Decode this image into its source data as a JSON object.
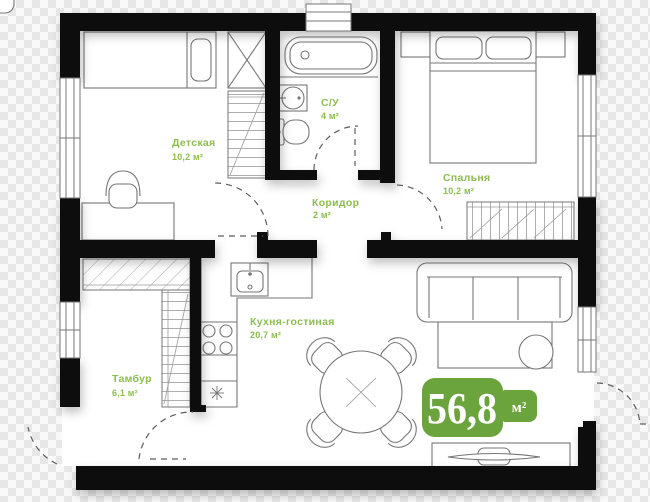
{
  "plan": {
    "rooms": {
      "children": {
        "name": "Детская",
        "area": "10,2 м²"
      },
      "bathroom": {
        "name": "С/У",
        "area": "4 м²"
      },
      "corridor": {
        "name": "Коридор",
        "area": "2 м²"
      },
      "bedroom": {
        "name": "Спальня",
        "area": "10,2 м²"
      },
      "kitchen_living": {
        "name": "Кухня-гостиная",
        "area": "20,7 м²"
      },
      "vestibule": {
        "name": "Тамбур",
        "area": "6,1 м²"
      }
    },
    "total_area_badge": {
      "value": "56,8",
      "unit": "м²"
    }
  },
  "colors": {
    "wall_black": "#0d0d0d",
    "furniture_line": "#767676",
    "label_green": "#8cbd4d",
    "badge_green": "#6ba43c",
    "badge_text": "#ffffff",
    "floor_white": "#ffffff",
    "checker_gray": "#e7e7e7"
  }
}
